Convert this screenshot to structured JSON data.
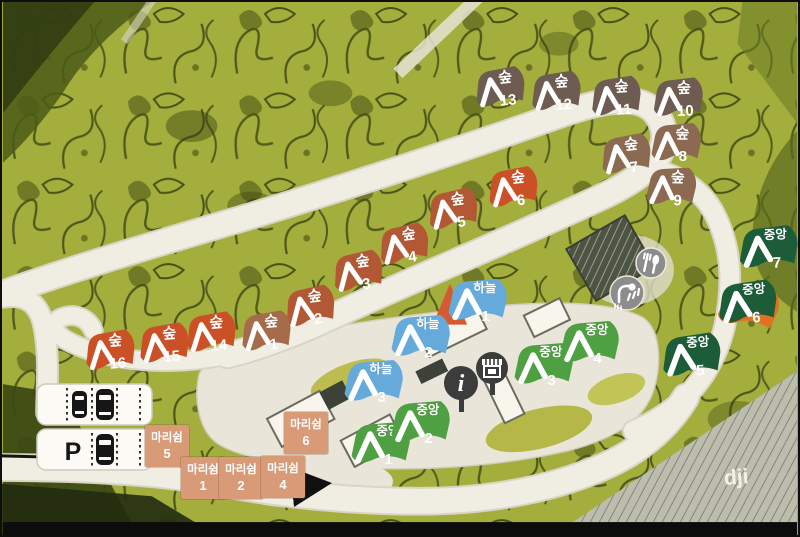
{
  "map": {
    "type": "campground-site-map",
    "watermark": "dji",
    "parking": {
      "label": "P",
      "icon": "parking-icon",
      "car_icon": "car-top-view-icon"
    },
    "colors": {
      "forest_dark_taupe": "#6e5b51",
      "forest_brown": "#8c6a52",
      "forest_light_brown": "#a56b4b",
      "forest_rust": "#b35834",
      "forest_orange": "#cc5026",
      "sky_blue": "#66aadc",
      "central_green": "#4f9f43",
      "central_dark_green": "#1d5c38",
      "mari_salmon": "#d99a78",
      "accent_orange": "#e2711f",
      "road": "#f0ede2",
      "foliage": "#a4ae3c"
    },
    "zone_labels": {
      "forest": "숲",
      "sky": "하늘",
      "central": "중앙",
      "mari": "마리쉼"
    },
    "tent_sites": [
      {
        "zone": "숲",
        "id": "forest-13",
        "number": "13",
        "color": "#6e5b51",
        "x": 496,
        "y": 88,
        "rot": -6
      },
      {
        "zone": "숲",
        "id": "forest-12",
        "number": "12",
        "color": "#6e5b51",
        "x": 552,
        "y": 92,
        "rot": -4
      },
      {
        "zone": "숲",
        "id": "forest-11",
        "number": "11",
        "color": "#6e5b51",
        "x": 612,
        "y": 97,
        "rot": -4
      },
      {
        "zone": "숲",
        "id": "forest-10",
        "number": "10",
        "color": "#6e5b51",
        "x": 674,
        "y": 98,
        "rot": -2
      },
      {
        "zone": "숲",
        "id": "forest-8",
        "number": "8",
        "color": "#8c6a52",
        "x": 672,
        "y": 143,
        "rot": 0
      },
      {
        "zone": "숲",
        "id": "forest-7",
        "number": "7",
        "color": "#8c6a52",
        "x": 622,
        "y": 155,
        "rot": -6
      },
      {
        "zone": "숲",
        "id": "forest-9",
        "number": "9",
        "color": "#8c6a52",
        "x": 667,
        "y": 187,
        "rot": 2
      },
      {
        "zone": "숲",
        "id": "forest-6",
        "number": "6",
        "color": "#cc5026",
        "x": 509,
        "y": 188,
        "rot": -6
      },
      {
        "zone": "숲",
        "id": "forest-5",
        "number": "5",
        "color": "#b35834",
        "x": 449,
        "y": 210,
        "rot": -8
      },
      {
        "zone": "숲",
        "id": "forest-4",
        "number": "4",
        "color": "#b35834",
        "x": 400,
        "y": 245,
        "rot": -8
      },
      {
        "zone": "숲",
        "id": "forest-3",
        "number": "3",
        "color": "#b35834",
        "x": 354,
        "y": 272,
        "rot": -8
      },
      {
        "zone": "숲",
        "id": "forest-2",
        "number": "2",
        "color": "#b35834",
        "x": 306,
        "y": 307,
        "rot": -8
      },
      {
        "zone": "숲",
        "id": "forest-1",
        "number": "1",
        "color": "#a56b4b",
        "x": 262,
        "y": 332,
        "rot": -5
      },
      {
        "zone": "숲",
        "id": "forest-14",
        "number": "14",
        "color": "#cc5026",
        "x": 207,
        "y": 333,
        "rot": -5
      },
      {
        "zone": "숲",
        "id": "forest-15",
        "number": "15",
        "color": "#cc5026",
        "x": 160,
        "y": 344,
        "rot": -5
      },
      {
        "zone": "숲",
        "id": "forest-16",
        "number": "16",
        "color": "#cc5026",
        "x": 106,
        "y": 351,
        "rot": -5
      },
      {
        "zone": "하늘",
        "id": "sky-1",
        "number": "1",
        "color": "#66aadc",
        "x": 473,
        "y": 301,
        "rot": 0,
        "back_tent": "#d45a32"
      },
      {
        "zone": "하늘",
        "id": "sky-2",
        "number": "2",
        "color": "#66aadc",
        "x": 416,
        "y": 337,
        "rot": 0
      },
      {
        "zone": "하늘",
        "id": "sky-3",
        "number": "3",
        "color": "#66aadc",
        "x": 369,
        "y": 382,
        "rot": 0
      },
      {
        "zone": "중앙",
        "id": "central-1",
        "number": "1",
        "color": "#4f9f43",
        "x": 376,
        "y": 444,
        "rot": 0
      },
      {
        "zone": "중앙",
        "id": "central-2",
        "number": "2",
        "color": "#4f9f43",
        "x": 416,
        "y": 423,
        "rot": 0
      },
      {
        "zone": "중앙",
        "id": "central-3",
        "number": "3",
        "color": "#4f9f43",
        "x": 539,
        "y": 365,
        "rot": 0
      },
      {
        "zone": "중앙",
        "id": "central-4",
        "number": "4",
        "color": "#4f9f43",
        "x": 585,
        "y": 343,
        "rot": 0
      },
      {
        "zone": "중앙",
        "id": "central-5",
        "number": "5",
        "color": "#1d5c38",
        "x": 687,
        "y": 356,
        "rot": -4
      },
      {
        "zone": "중앙",
        "id": "central-6",
        "number": "6",
        "color": "#1d5c38",
        "x": 743,
        "y": 303,
        "rot": -4,
        "accent": "#e2711f"
      },
      {
        "zone": "중앙",
        "id": "central-7",
        "number": "7",
        "color": "#1d5c38",
        "x": 764,
        "y": 248,
        "rot": -2
      }
    ],
    "rect_sites": [
      {
        "zone": "마리쉼",
        "id": "mari-5",
        "number": "5",
        "x": 165,
        "y": 444
      },
      {
        "zone": "마리쉼",
        "id": "mari-6",
        "number": "6",
        "x": 304,
        "y": 431
      },
      {
        "zone": "마리쉼",
        "id": "mari-1",
        "number": "1",
        "x": 201,
        "y": 476
      },
      {
        "zone": "마리쉼",
        "id": "mari-2",
        "number": "2",
        "x": 239,
        "y": 476
      },
      {
        "zone": "마리쉼",
        "id": "mari-4",
        "number": "4",
        "x": 281,
        "y": 475
      }
    ],
    "facilities": [
      {
        "id": "information",
        "icon": "info-icon",
        "glyph": "i",
        "x": 459,
        "y": 381
      },
      {
        "id": "store",
        "icon": "store-icon",
        "x": 490,
        "y": 366
      },
      {
        "id": "shower",
        "icon": "shower-icon",
        "x": 625,
        "y": 291
      },
      {
        "id": "cookhouse",
        "icon": "utensils-icon",
        "x": 649,
        "y": 261
      }
    ]
  }
}
